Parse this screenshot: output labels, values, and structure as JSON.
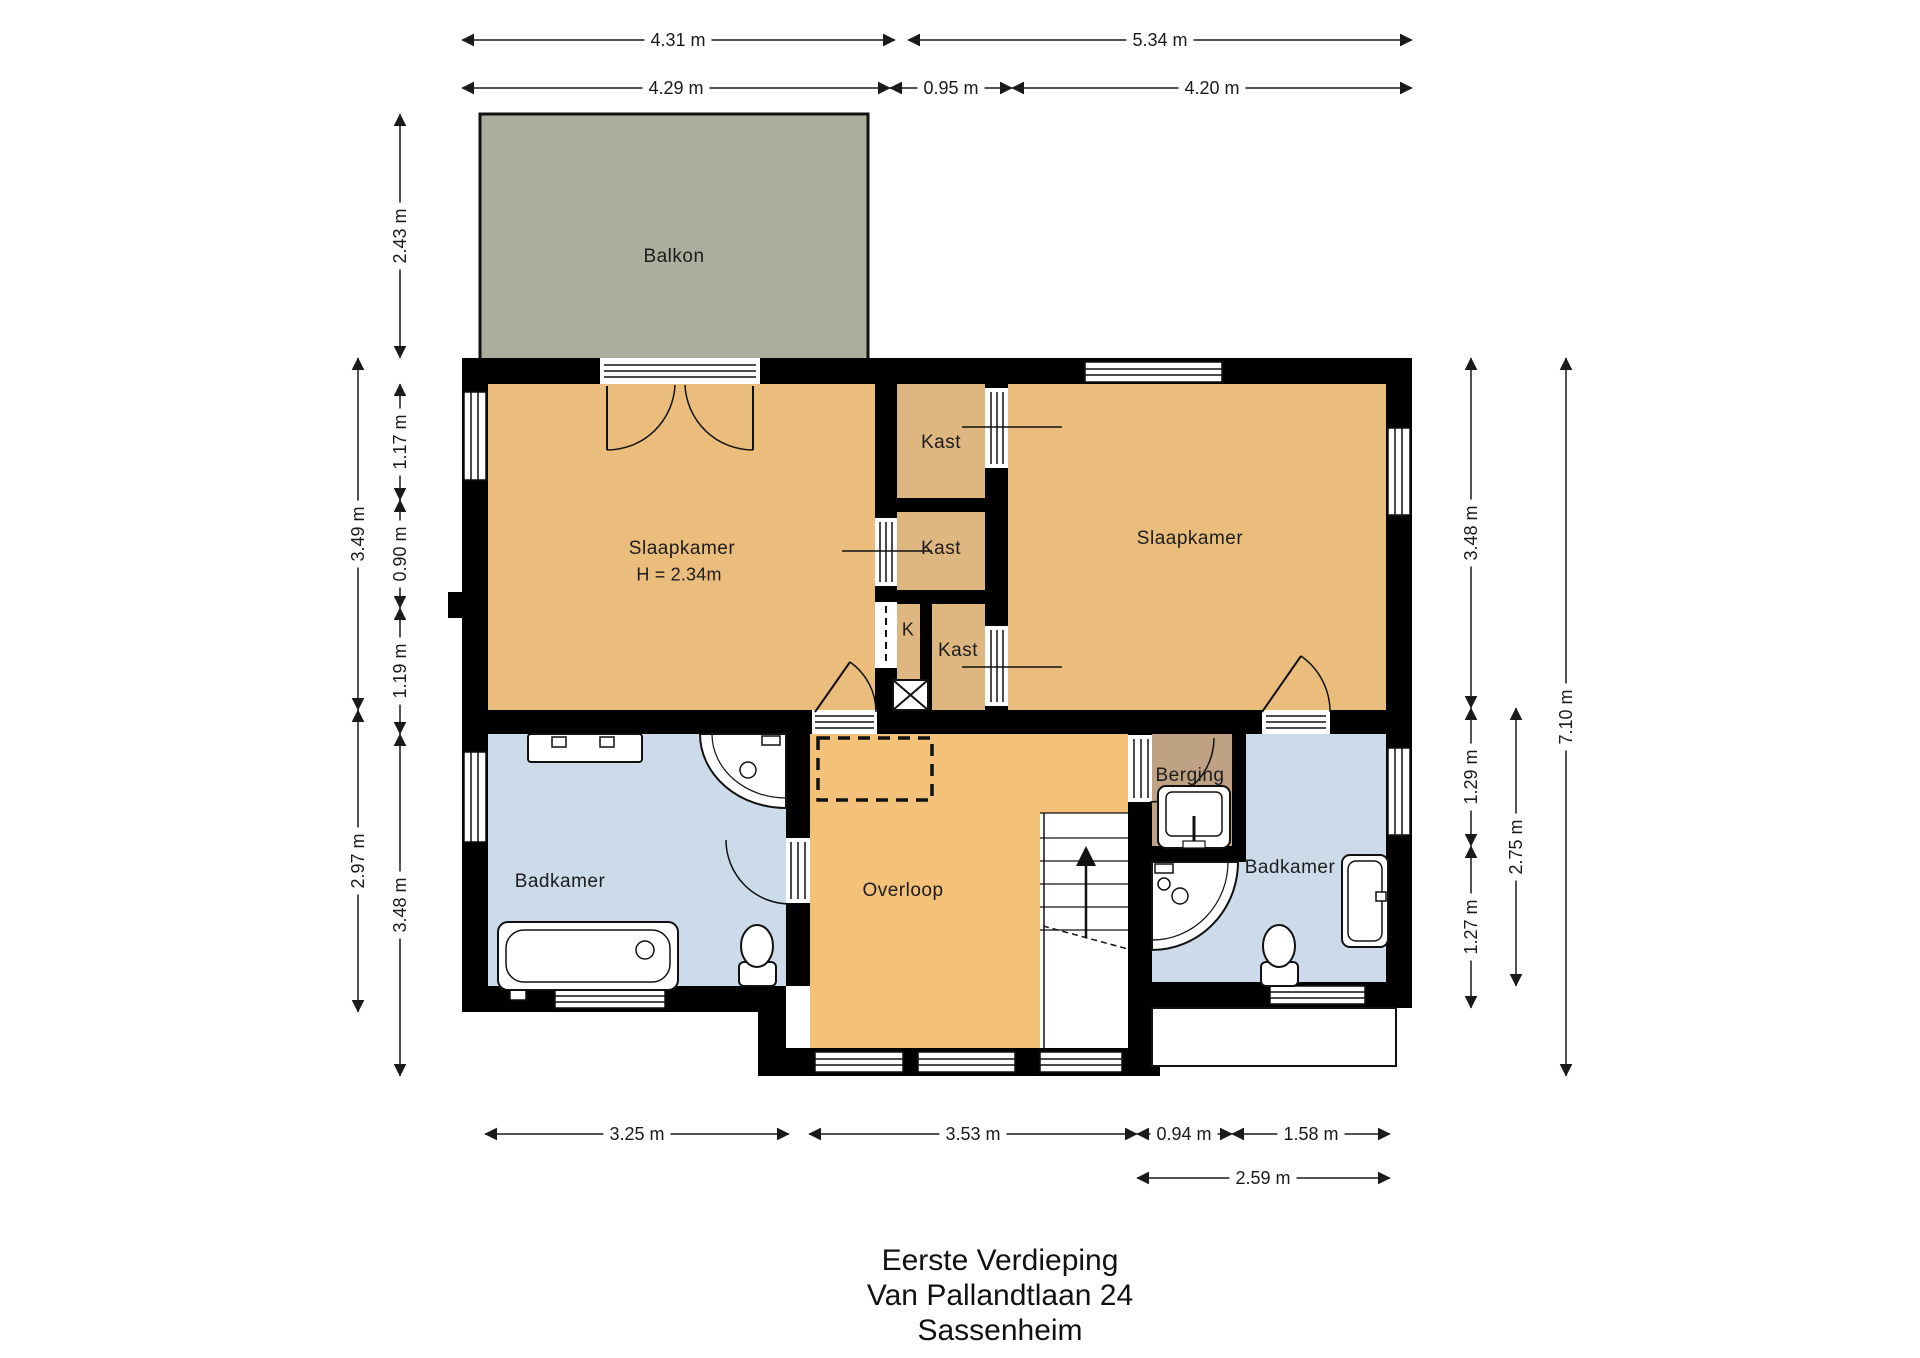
{
  "title": {
    "lines": [
      "Eerste Verdieping",
      "Van Pallandtlaan 24",
      "Sassenheim"
    ]
  },
  "rooms": {
    "balkon": "Balkon",
    "slaapkamer_left": "Slaapkamer",
    "slaapkamer_left_height": "H = 2.34m",
    "slaapkamer_right": "Slaapkamer",
    "kast1": "Kast",
    "kast2": "Kast",
    "kast3": "Kast",
    "k": "K",
    "berging": "Berging",
    "badkamer_left": "Badkamer",
    "badkamer_right": "Badkamer",
    "overloop": "Overloop"
  },
  "dims": {
    "top1": [
      "4.31 m",
      "5.34 m"
    ],
    "top2": [
      "4.29 m",
      "0.95 m",
      "4.20 m"
    ],
    "left_outer": [
      "3.49 m",
      "2.97 m"
    ],
    "left_inner": [
      "2.43 m",
      "1.17 m",
      "0.90 m",
      "1.19 m",
      "3.48 m"
    ],
    "right_inner": [
      "3.48 m",
      "1.29 m",
      "1.27 m"
    ],
    "right_mid": [
      "2.75 m"
    ],
    "right_outer": [
      "7.10 m"
    ],
    "bottom1": [
      "3.25 m",
      "3.53 m",
      "0.94 m",
      "1.58 m"
    ],
    "bottom2": [
      "2.59 m"
    ]
  },
  "colors": {
    "wall": "#000000",
    "bedroom": "#EBBD7D",
    "closet": "#DEB680",
    "hallway": "#F4C178",
    "storage": "#BFA184",
    "bathroom": "#CCDAEA",
    "balcony": "#A9AE9D",
    "dimension_text": "#1a1a1a"
  }
}
